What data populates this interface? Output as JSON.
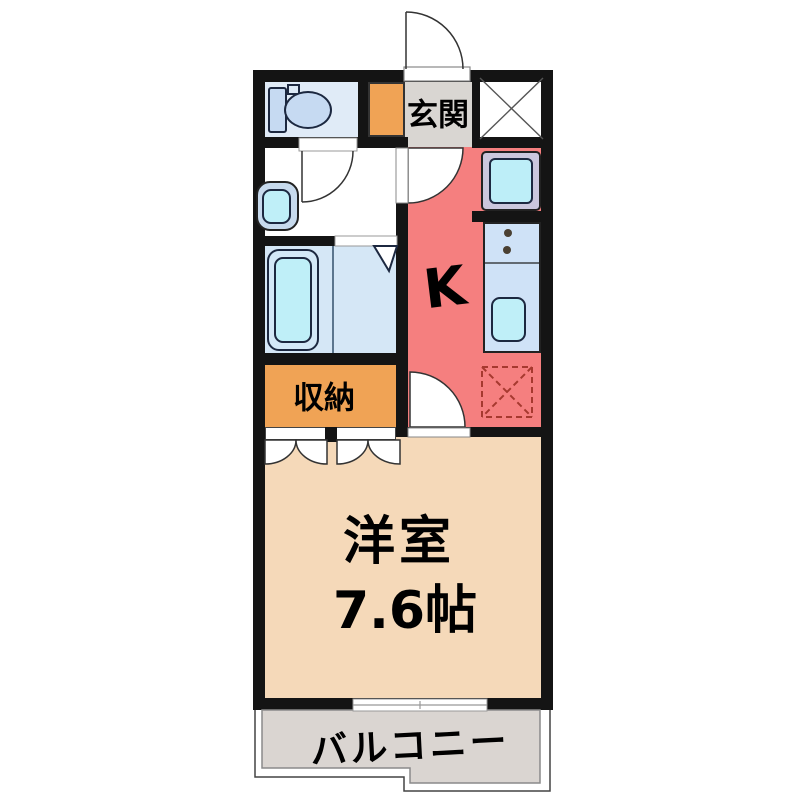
{
  "palette": {
    "wall": "#141414",
    "kitchen": "#F57F7F",
    "room": "#F5D9B9",
    "storage": "#F0A355",
    "entrance": "#D9D6D2",
    "balcony": "#DAD5D1",
    "toiletfloor": "#E0EBF7",
    "bathfloor": "#D5E7F6",
    "counter": "#CFE2F7",
    "fixture": "#C6DAF2",
    "basin": "#BFEFF8",
    "pan": "#CBC7DD",
    "fridgedash": "#A6392F",
    "line": "#333333"
  },
  "plan": {
    "labels": {
      "entrance": "玄関",
      "kitchen": "K",
      "storage": "収納",
      "room_name": "洋室",
      "room_size": "7.6帖",
      "balcony": "バルコニー"
    }
  }
}
